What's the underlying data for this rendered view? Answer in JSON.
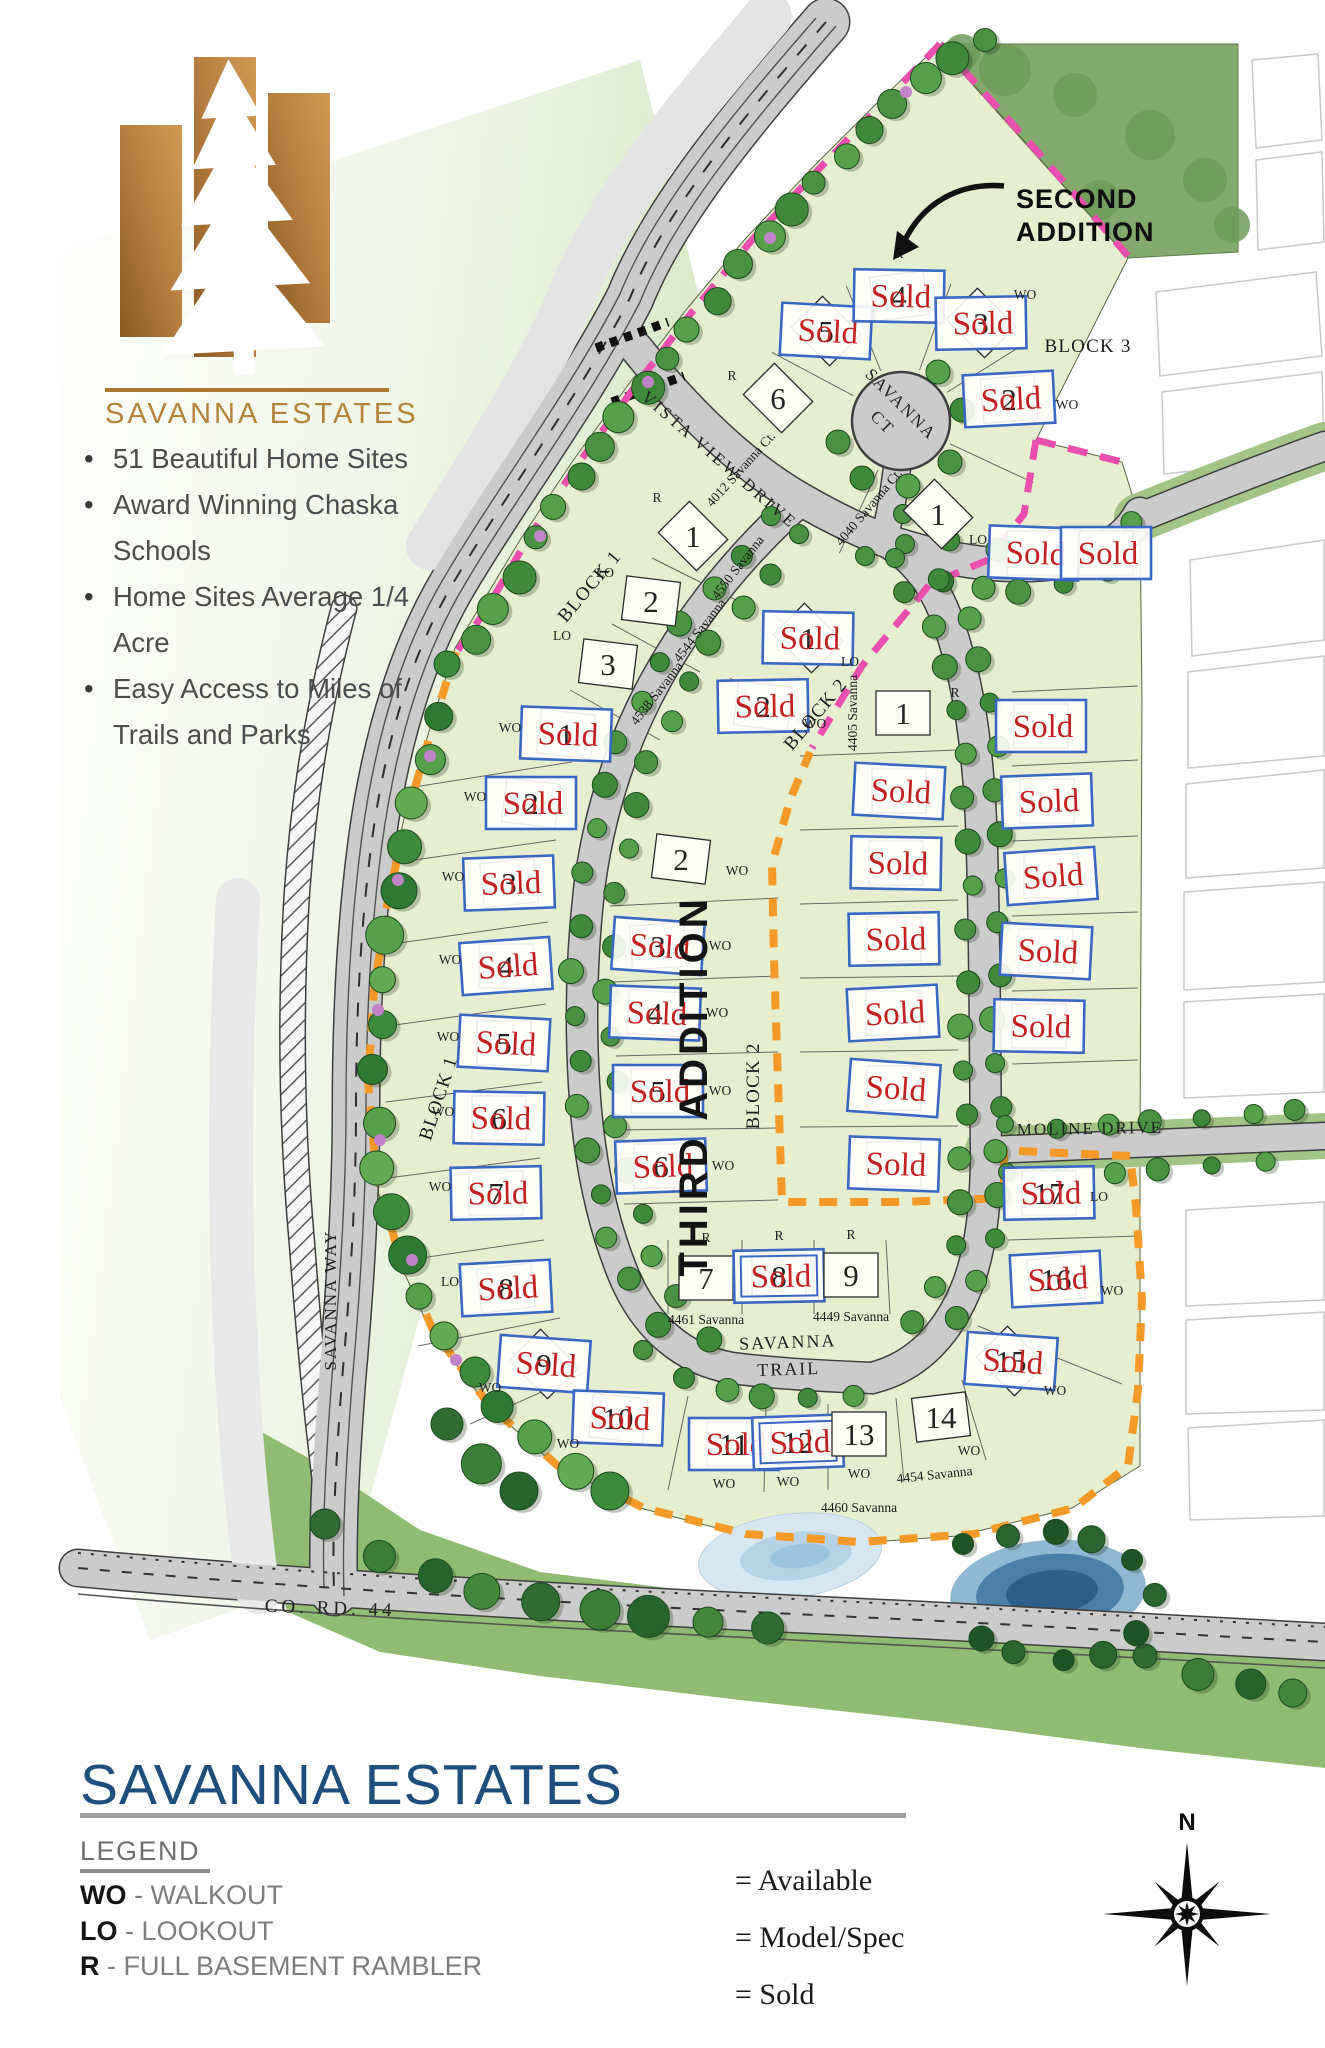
{
  "brand": {
    "name": "SAVANNA  ESTATES",
    "bullets": [
      "51 Beautiful Home Sites",
      "Award Winning Chaska Schools",
      "Home Sites Average 1/4 Acre",
      "Easy Access to Miles of Trails and Parks"
    ]
  },
  "footer": {
    "title": "SAVANNA ESTATES",
    "legend_heading": "LEGEND",
    "legend_items": [
      {
        "abbr": "WO",
        "desc": "- WALKOUT"
      },
      {
        "abbr": "LO",
        "desc": "- LOOKOUT"
      },
      {
        "abbr": "R",
        "desc": "- FULL BASEMENT RAMBLER"
      }
    ],
    "status_items": [
      "= Available",
      "= Model/Spec",
      "= Sold"
    ],
    "compass_north": "N"
  },
  "map": {
    "sold_label": "Sold",
    "second_addition": {
      "lines": [
        "SECOND",
        "ADDITION"
      ],
      "x": 1016,
      "y": 208,
      "lh": 33
    },
    "third_addition": {
      "text": "THIRD ADDITION",
      "x": 707,
      "y": 1086,
      "rot": -90
    },
    "block_labels": [
      {
        "text": "BLOCK 1",
        "x": 594,
        "y": 590,
        "rot": -50
      },
      {
        "text": "BLOCK 2",
        "x": 820,
        "y": 718,
        "rot": -50
      },
      {
        "text": "BLOCK 3",
        "x": 1088,
        "y": 352,
        "rot": 0
      },
      {
        "text": "BLOCK 1",
        "x": 444,
        "y": 1100,
        "rot": -72
      },
      {
        "text": "BLOCK 2",
        "x": 759,
        "y": 1086,
        "rot": -90
      }
    ],
    "street_labels": [
      {
        "lines": [
          "VISTA VIEW DRIVE"
        ],
        "x": 716,
        "y": 464,
        "rot": 41,
        "ls": 3,
        "fs": 17
      },
      {
        "lines": [
          "SAVANNA",
          "CT"
        ],
        "x": 897,
        "y": 408,
        "rot": 45,
        "ls": 2,
        "fs": 17,
        "lh": 26
      },
      {
        "lines": [
          "SAVANNA",
          "TRAIL"
        ],
        "x": 788,
        "y": 1348,
        "rot": -2,
        "ls": 2,
        "fs": 18,
        "lh": 27
      },
      {
        "lines": [
          "MOLINE DRIVE"
        ],
        "x": 1090,
        "y": 1134,
        "rot": -1,
        "ls": 2,
        "fs": 17
      },
      {
        "lines": [
          "SAVANNA WAY"
        ],
        "x": 336,
        "y": 1300,
        "rot": -90,
        "ls": 2,
        "fs": 17
      },
      {
        "lines": [
          "CO. RD. 44"
        ],
        "x": 330,
        "y": 1614,
        "rot": 2,
        "ls": 4,
        "fs": 19
      }
    ],
    "lots": [
      {
        "n": "6",
        "x": 778,
        "y": 398,
        "r": 45,
        "t": "R",
        "tp": [
          -46,
          -18
        ],
        "a": "4012 Savanna Ct.",
        "ap": [
          -34,
          74
        ],
        "ar": -48
      },
      {
        "n": "5",
        "x": 826,
        "y": 331,
        "r": 45,
        "sold": true
      },
      {
        "n": "4",
        "x": 899,
        "y": 296,
        "r": -7,
        "sold": true,
        "t": "R",
        "tp": [
          0,
          -38
        ]
      },
      {
        "n": "3",
        "x": 981,
        "y": 323,
        "r": 45,
        "sold": true,
        "t": "WO",
        "tp": [
          44,
          -24
        ]
      },
      {
        "n": "2",
        "x": 1009,
        "y": 399,
        "r": -5,
        "sold": true,
        "t": "WO",
        "tp": [
          58,
          10
        ]
      },
      {
        "n": "1",
        "x": 938,
        "y": 514,
        "r": 45,
        "t": "LO",
        "tp": [
          40,
          30
        ],
        "a": "4040 Savanna Ct.",
        "ap": [
          -66,
          -4
        ],
        "ar": -50
      },
      {
        "n": "",
        "x": 1034,
        "y": 553,
        "r": 0,
        "sold": true
      },
      {
        "n": "",
        "x": 1106,
        "y": 553,
        "r": 0,
        "sold": true
      },
      {
        "n": "1",
        "x": 693,
        "y": 536,
        "r": 45,
        "t": "R",
        "tp": [
          -36,
          -34
        ],
        "a": "4550 Savanna",
        "ap": [
          48,
          34
        ],
        "ar": -52
      },
      {
        "n": "2",
        "x": 651,
        "y": 601,
        "r": 7,
        "t": "LO",
        "tp": [
          -46,
          -24
        ],
        "a": "4544 Savanna",
        "ap": [
          52,
          32
        ],
        "ar": -52
      },
      {
        "n": "3",
        "x": 608,
        "y": 664,
        "r": 7,
        "t": "LO",
        "tp": [
          -46,
          -24
        ],
        "a": "4538 Savanna",
        "ap": [
          52,
          32
        ],
        "ar": -52
      },
      {
        "n": "1",
        "x": 808,
        "y": 638,
        "r": 45,
        "sold": true,
        "t": "LO",
        "tp": [
          42,
          28
        ]
      },
      {
        "n": "2",
        "x": 763,
        "y": 706,
        "r": 7,
        "sold": true,
        "t": "WO",
        "tp": [
          52,
          22
        ]
      },
      {
        "n": "2",
        "x": 681,
        "y": 859,
        "r": 7,
        "t": "WO",
        "tp": [
          56,
          16
        ]
      },
      {
        "n": "3",
        "x": 658,
        "y": 946,
        "r": -4,
        "sold": true,
        "t": "WO",
        "tp": [
          62,
          4
        ]
      },
      {
        "n": "4",
        "x": 655,
        "y": 1013,
        "r": 4,
        "sold": true,
        "t": "WO",
        "tp": [
          62,
          4
        ]
      },
      {
        "n": "5",
        "x": 658,
        "y": 1091,
        "r": 0,
        "sold": true,
        "t": "WO",
        "tp": [
          62,
          4
        ]
      },
      {
        "n": "6",
        "x": 661,
        "y": 1166,
        "r": 0,
        "sold": true,
        "t": "WO",
        "tp": [
          62,
          4
        ]
      },
      {
        "n": "1",
        "x": 903,
        "y": 713,
        "r": 0,
        "t": "R",
        "tp": [
          52,
          -16
        ],
        "a": "4405 Savanna",
        "ap": [
          -46,
          0
        ],
        "ar": -90
      },
      {
        "n": "",
        "x": 899,
        "y": 791,
        "r": 0,
        "sold": true
      },
      {
        "n": "",
        "x": 896,
        "y": 863,
        "r": 0,
        "sold": true
      },
      {
        "n": "",
        "x": 894,
        "y": 939,
        "r": 0,
        "sold": true
      },
      {
        "n": "",
        "x": 893,
        "y": 1013,
        "r": 0,
        "sold": true
      },
      {
        "n": "",
        "x": 894,
        "y": 1088,
        "r": 0,
        "sold": true
      },
      {
        "n": "",
        "x": 894,
        "y": 1164,
        "r": 0,
        "sold": true
      },
      {
        "n": "",
        "x": 1041,
        "y": 726,
        "r": 0,
        "sold": true
      },
      {
        "n": "",
        "x": 1047,
        "y": 801,
        "r": 0,
        "sold": true
      },
      {
        "n": "",
        "x": 1051,
        "y": 876,
        "r": 0,
        "sold": true
      },
      {
        "n": "",
        "x": 1046,
        "y": 951,
        "r": 0,
        "sold": true
      },
      {
        "n": "",
        "x": 1039,
        "y": 1026,
        "r": 0,
        "sold": true
      },
      {
        "n": "17",
        "x": 1049,
        "y": 1193,
        "r": 0,
        "sold": true,
        "t": "LO",
        "tp": [
          50,
          8
        ]
      },
      {
        "n": "16",
        "x": 1056,
        "y": 1279,
        "r": -7,
        "sold": true,
        "t": "WO",
        "tp": [
          56,
          16
        ]
      },
      {
        "n": "15",
        "x": 1011,
        "y": 1361,
        "r": 45,
        "sold": true,
        "t": "WO",
        "tp": [
          44,
          34
        ]
      },
      {
        "n": "1",
        "x": 566,
        "y": 734,
        "r": 7,
        "sold": true,
        "t": "WO",
        "tp": [
          -56,
          -2
        ]
      },
      {
        "n": "2",
        "x": 531,
        "y": 803,
        "r": 7,
        "sold": true,
        "t": "WO",
        "tp": [
          -56,
          -2
        ]
      },
      {
        "n": "3",
        "x": 509,
        "y": 883,
        "r": -6,
        "sold": true,
        "t": "WO",
        "tp": [
          -56,
          -2
        ]
      },
      {
        "n": "4",
        "x": 506,
        "y": 966,
        "r": 0,
        "sold": true,
        "t": "WO",
        "tp": [
          -56,
          -2
        ]
      },
      {
        "n": "5",
        "x": 504,
        "y": 1043,
        "r": 0,
        "sold": true,
        "t": "WO",
        "tp": [
          -56,
          -2
        ]
      },
      {
        "n": "6",
        "x": 499,
        "y": 1118,
        "r": 0,
        "sold": true,
        "t": "WO",
        "tp": [
          -56,
          -2
        ]
      },
      {
        "n": "7",
        "x": 496,
        "y": 1193,
        "r": 0,
        "sold": true,
        "t": "WO",
        "tp": [
          -56,
          -2
        ]
      },
      {
        "n": "8",
        "x": 506,
        "y": 1288,
        "r": -7,
        "sold": true,
        "t": "LO",
        "tp": [
          -56,
          -2
        ]
      },
      {
        "n": "9",
        "x": 544,
        "y": 1364,
        "r": 45,
        "sold": true,
        "t": "WO",
        "tp": [
          -54,
          28
        ]
      },
      {
        "n": "10",
        "x": 618,
        "y": 1418,
        "r": 7,
        "sold": true,
        "t": "WO",
        "tp": [
          -50,
          30
        ]
      },
      {
        "n": "11",
        "x": 734,
        "y": 1444,
        "r": 0,
        "sold": true,
        "t": "WO",
        "tp": [
          -10,
          44
        ]
      },
      {
        "n": "12",
        "x": 798,
        "y": 1442,
        "r": 0,
        "sold": true,
        "spec": true,
        "t": "WO",
        "tp": [
          -10,
          44
        ]
      },
      {
        "n": "13",
        "x": 859,
        "y": 1434,
        "r": 0,
        "t": "WO",
        "tp": [
          0,
          44
        ],
        "a": "4460 Savanna",
        "ap": [
          0,
          78
        ],
        "ar": 0
      },
      {
        "n": "14",
        "x": 941,
        "y": 1417,
        "r": -7,
        "t": "WO",
        "tp": [
          28,
          38
        ],
        "a": "4454 Savanna",
        "ap": [
          -6,
          62
        ],
        "ar": -6
      },
      {
        "n": "7",
        "x": 706,
        "y": 1278,
        "r": 0,
        "t": "R",
        "tp": [
          0,
          -36
        ],
        "a": "4461 Savanna",
        "ap": [
          0,
          46
        ],
        "ar": 0
      },
      {
        "n": "8",
        "x": 779,
        "y": 1276,
        "r": 0,
        "sold": true,
        "spec": true,
        "t": "R",
        "tp": [
          0,
          -36
        ]
      },
      {
        "n": "9",
        "x": 851,
        "y": 1275,
        "r": 0,
        "t": "R",
        "tp": [
          0,
          -36
        ],
        "a": "4449 Savanna",
        "ap": [
          0,
          46
        ],
        "ar": 0
      }
    ]
  }
}
